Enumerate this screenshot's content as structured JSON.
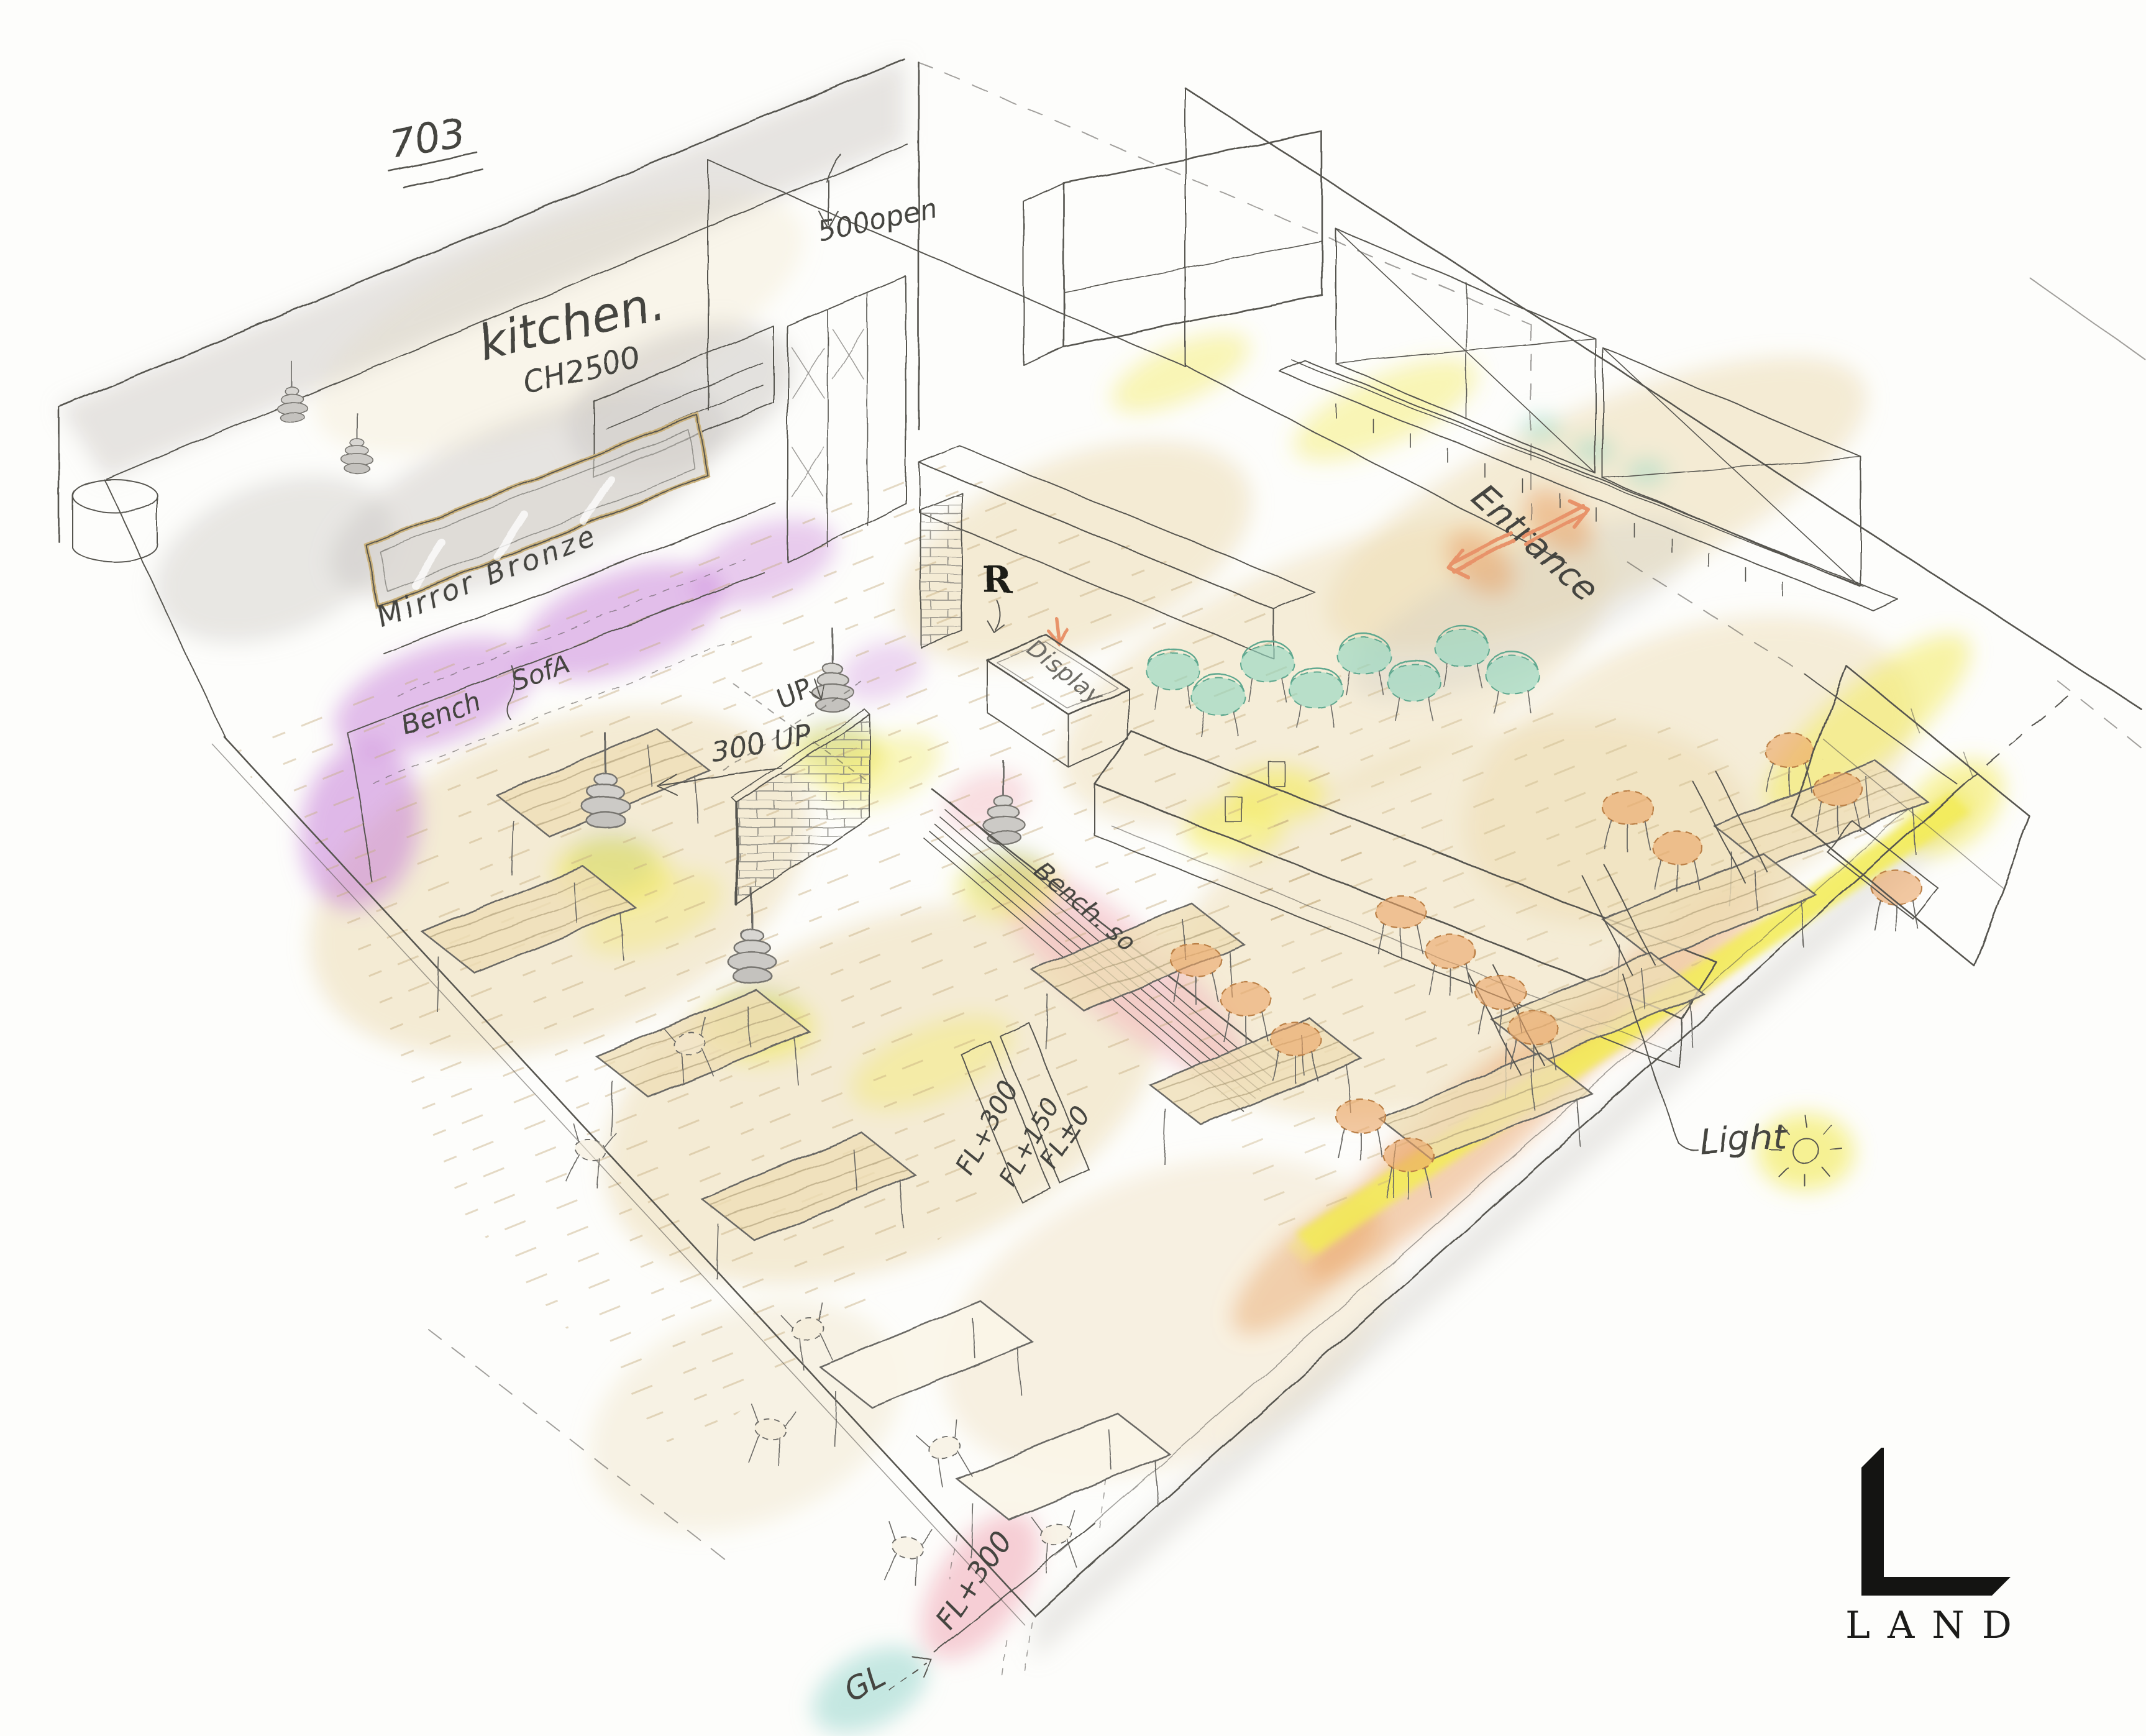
{
  "page": {
    "type": "hand-drawn interior perspective sketch",
    "subject": "restaurant dining room and kitchen, isometric watercolor rendering",
    "background": "#fdfdfb"
  },
  "annotations": {
    "room_number": "703",
    "kitchen_label": "kitchen.",
    "kitchen_ceiling_height": "CH2500",
    "opening_dimension": "500open",
    "mirror_finish": "Mirror Bronze",
    "bench_label": "Bench",
    "sofa_label": "SofA",
    "entrance_label": "Entrance",
    "display_label": "Display",
    "register_mark": "R",
    "floor_step_up": "300 UP",
    "stair_up": "UP",
    "center_bench": "Bench. so",
    "floor_levels": [
      "FL+300",
      "FL+150",
      "FL±0"
    ],
    "light_note": "Light",
    "front_floor_level": "FL+300",
    "ground_level": "GL"
  },
  "logo": {
    "mark": "L",
    "wordmark": "LAND"
  },
  "palette": {
    "pencil": "#56544f",
    "wood_wash": "#ecd9ae",
    "wood_light": "#f4ead0",
    "purple_sofa": "#c77fd9",
    "teal_chair": "#8fd4bf",
    "sage_shade": "#9fb9a8",
    "orange_stool": "#eaa368",
    "orange_arrow": "#e8936a",
    "yellow_light": "#f2e94f",
    "pink_bench": "#f2afbc",
    "gl_teal": "#9ed8d0",
    "wall_gray": "#cfccc7",
    "logo_black": "#141412"
  }
}
